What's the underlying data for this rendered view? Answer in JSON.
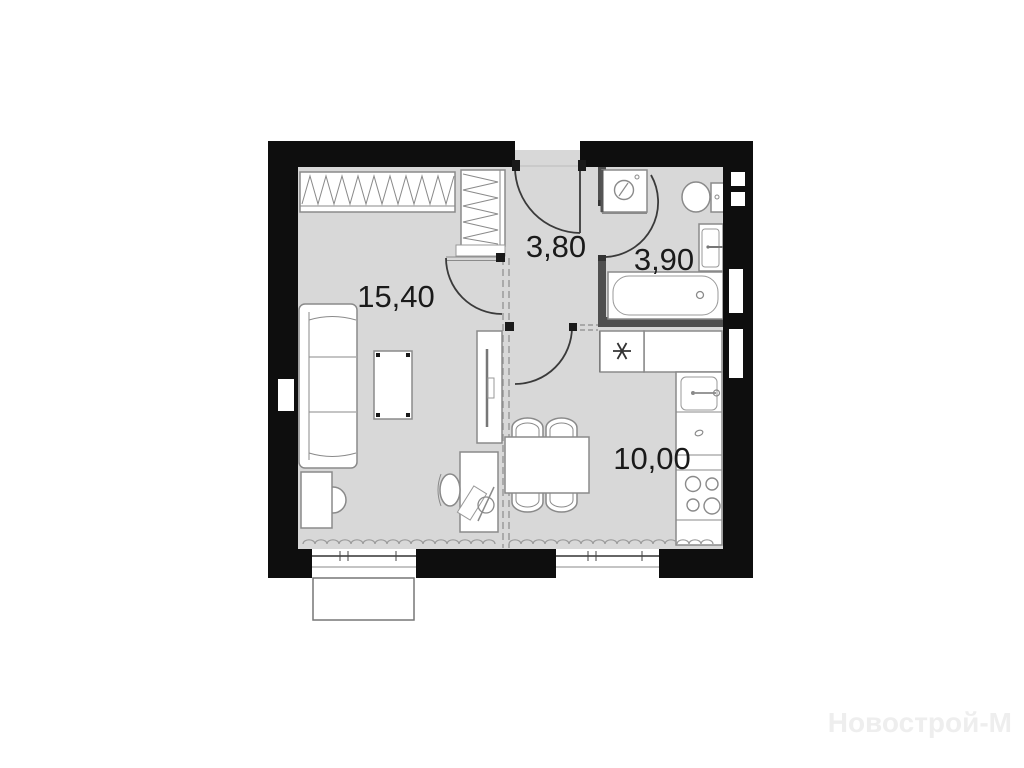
{
  "floorplan": {
    "type": "apartment-floor-plan",
    "watermark": "Новострой-М",
    "rooms": {
      "living": {
        "name": "living-room",
        "area": "15,40"
      },
      "hall": {
        "name": "hallway",
        "area": "3,80"
      },
      "bath": {
        "name": "bathroom",
        "area": "3,90"
      },
      "kitchen": {
        "name": "kitchen",
        "area": "10,00"
      }
    },
    "fixtures": [
      "wardrobe-hanging-rail",
      "hall-closet",
      "sofa",
      "side-table",
      "coffee-table",
      "tv-stand",
      "desk",
      "office-chair",
      "desk-lamp",
      "laptop",
      "dining-table",
      "dining-chairs",
      "refrigerator",
      "kitchen-counter",
      "kitchen-sink",
      "stove-4-burner",
      "washing-machine",
      "toilet",
      "bathroom-sink",
      "bathtub",
      "radiators",
      "windows",
      "balcony"
    ],
    "colors": {
      "wall": "#0e0e0e",
      "floor": "#d8d8d8",
      "interior_wall": "#4f4f4f",
      "furniture_stroke": "#8a8a8a",
      "door_arc": "#3a3a3a",
      "dashed_partition": "#9a9a9a",
      "label_text": "#1a1a1a",
      "watermark_text": "#eeeeee",
      "background": "#ffffff"
    }
  }
}
